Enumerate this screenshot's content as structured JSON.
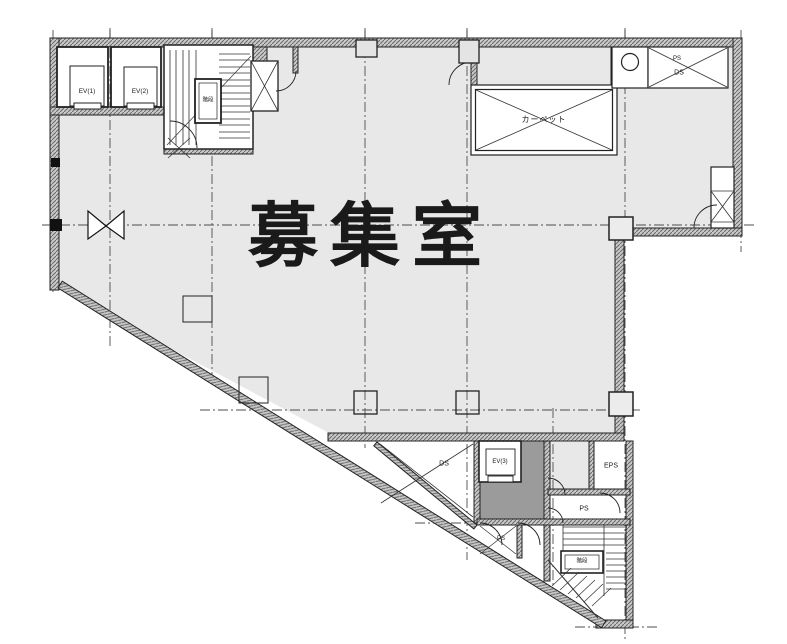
{
  "colors": {
    "background": "#ffffff",
    "floor": "#e8e8e8",
    "dark_shaft": "#9b9b9b",
    "line": "#1a1a1a"
  },
  "labels": {
    "main_room": "募集室",
    "ev1": "EV(1)",
    "ev2": "EV(2)",
    "ev3": "EV(3)",
    "stairs_top": "階段",
    "stairs_bottom": "階段",
    "ps_top": "PS",
    "ds_top": "DS",
    "carpet_shaft": "カーペット",
    "ds_bottom": "DS",
    "eps": "EPS",
    "ps_mid": "PS",
    "ps_small": "PS"
  }
}
